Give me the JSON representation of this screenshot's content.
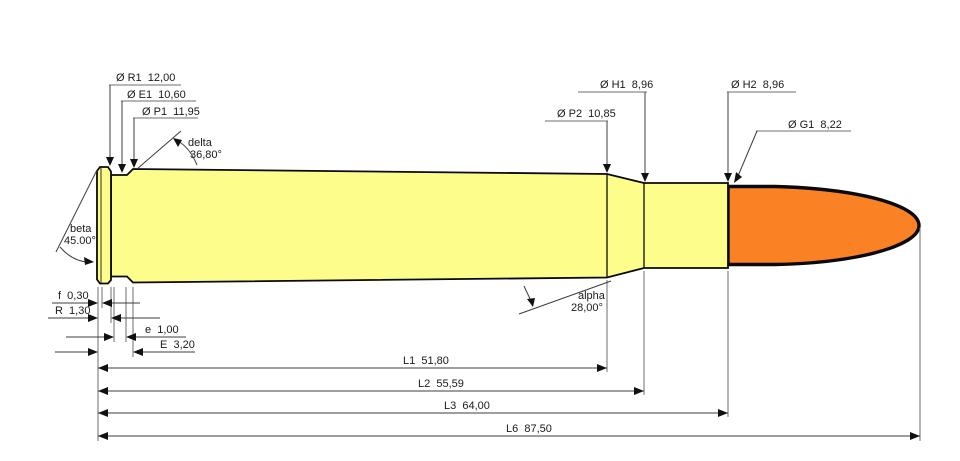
{
  "diagram_type": "cartridge-dimension-drawing",
  "colors": {
    "background": "#ffffff",
    "case": "#FDFD8C",
    "bullet": "#FB8125",
    "outline": "#0a0a0a",
    "dimension_lines": "#3c3c3c"
  },
  "annotations": {
    "r1": "Ø R1  12,00",
    "e1": "Ø E1  10,60",
    "p1": "Ø P1  11,95",
    "delta_name": "delta",
    "delta_value": "36,80°",
    "h1": "Ø H1  8,96",
    "p2": "Ø P2  10,85",
    "h2": "Ø H2  8,96",
    "g1": "Ø G1  8,22",
    "beta_name": "beta",
    "beta_value": "45.00°",
    "f": "f  0,30",
    "r": "R  1,30",
    "e": "e  1,00",
    "E": "E  3,20",
    "alpha_name": "alpha",
    "alpha_value": "28,00°",
    "l1": "L1  51,80",
    "l2": "L2  55,59",
    "l3": "L3  64,00",
    "l6": "L6  87,50"
  },
  "values": {
    "R1": 12.0,
    "E1": 10.6,
    "P1": 11.95,
    "delta_deg": 36.8,
    "H1": 8.96,
    "P2": 10.85,
    "H2": 8.96,
    "G1": 8.22,
    "beta_deg": 45.0,
    "f": 0.3,
    "R": 1.3,
    "e": 1.0,
    "E": 3.2,
    "alpha_deg": 28.0,
    "L1": 51.8,
    "L2": 55.59,
    "L3": 64.0,
    "L6": 87.5
  }
}
